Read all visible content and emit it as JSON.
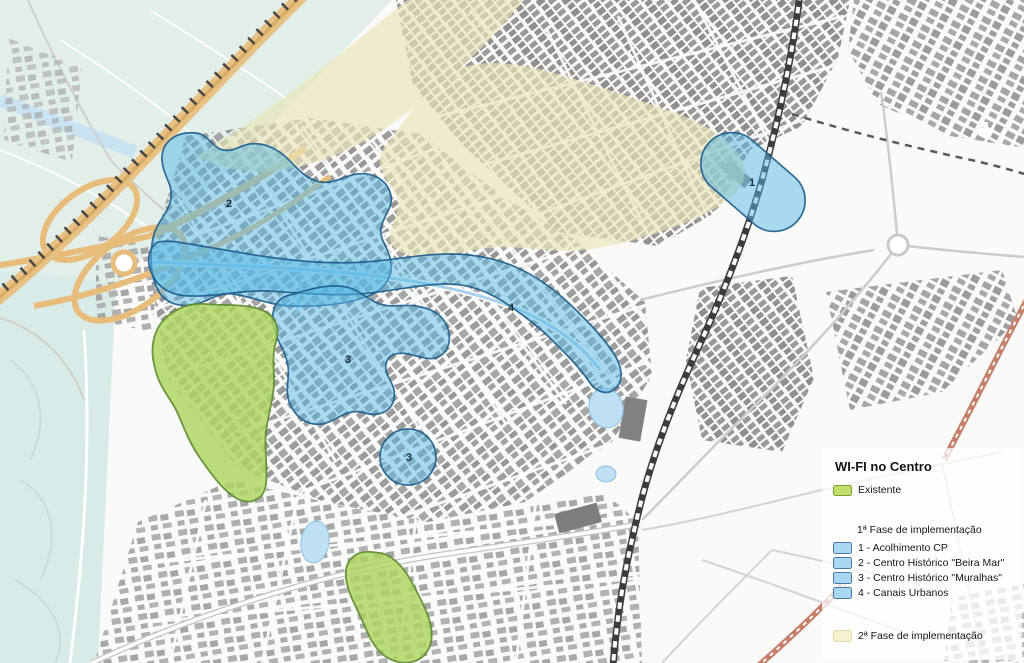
{
  "legend": {
    "title": "WI-FI no Centro",
    "existing": {
      "label": "Existente",
      "color": "#c3df69"
    },
    "phase1": {
      "title": "1ª Fase de implementação",
      "swatch_color": "#a9d9f2",
      "items": [
        {
          "label": "1 - Acolhimento CP"
        },
        {
          "label": "2 - Centro Histórico \"Beira Mar\""
        },
        {
          "label": "3 - Centro Histórico \"Muralhas\""
        },
        {
          "label": "4 - Canais Urbanos"
        }
      ]
    },
    "phase2": {
      "title": "2ª Fase de implementação",
      "swatch_color": "#f6f2cf"
    }
  },
  "map": {
    "zone_labels": [
      {
        "text": "1"
      },
      {
        "text": "2"
      },
      {
        "text": "3"
      },
      {
        "text": "3"
      },
      {
        "text": "4"
      }
    ],
    "colors": {
      "phase1_fill": "#55b7e3",
      "phase1_border": "#1e5d8d",
      "existing_fill": "#aed45f",
      "existing_border": "#5e8a33",
      "phase2_fill": "#e9e4b8",
      "water": "#d8ebe8",
      "fields": "#e2efe9",
      "buildings": "#a0a0a0",
      "highway_orange": "#e9bd7e",
      "railway": "#3f3f3f",
      "red_road": "#c57f6a"
    }
  }
}
